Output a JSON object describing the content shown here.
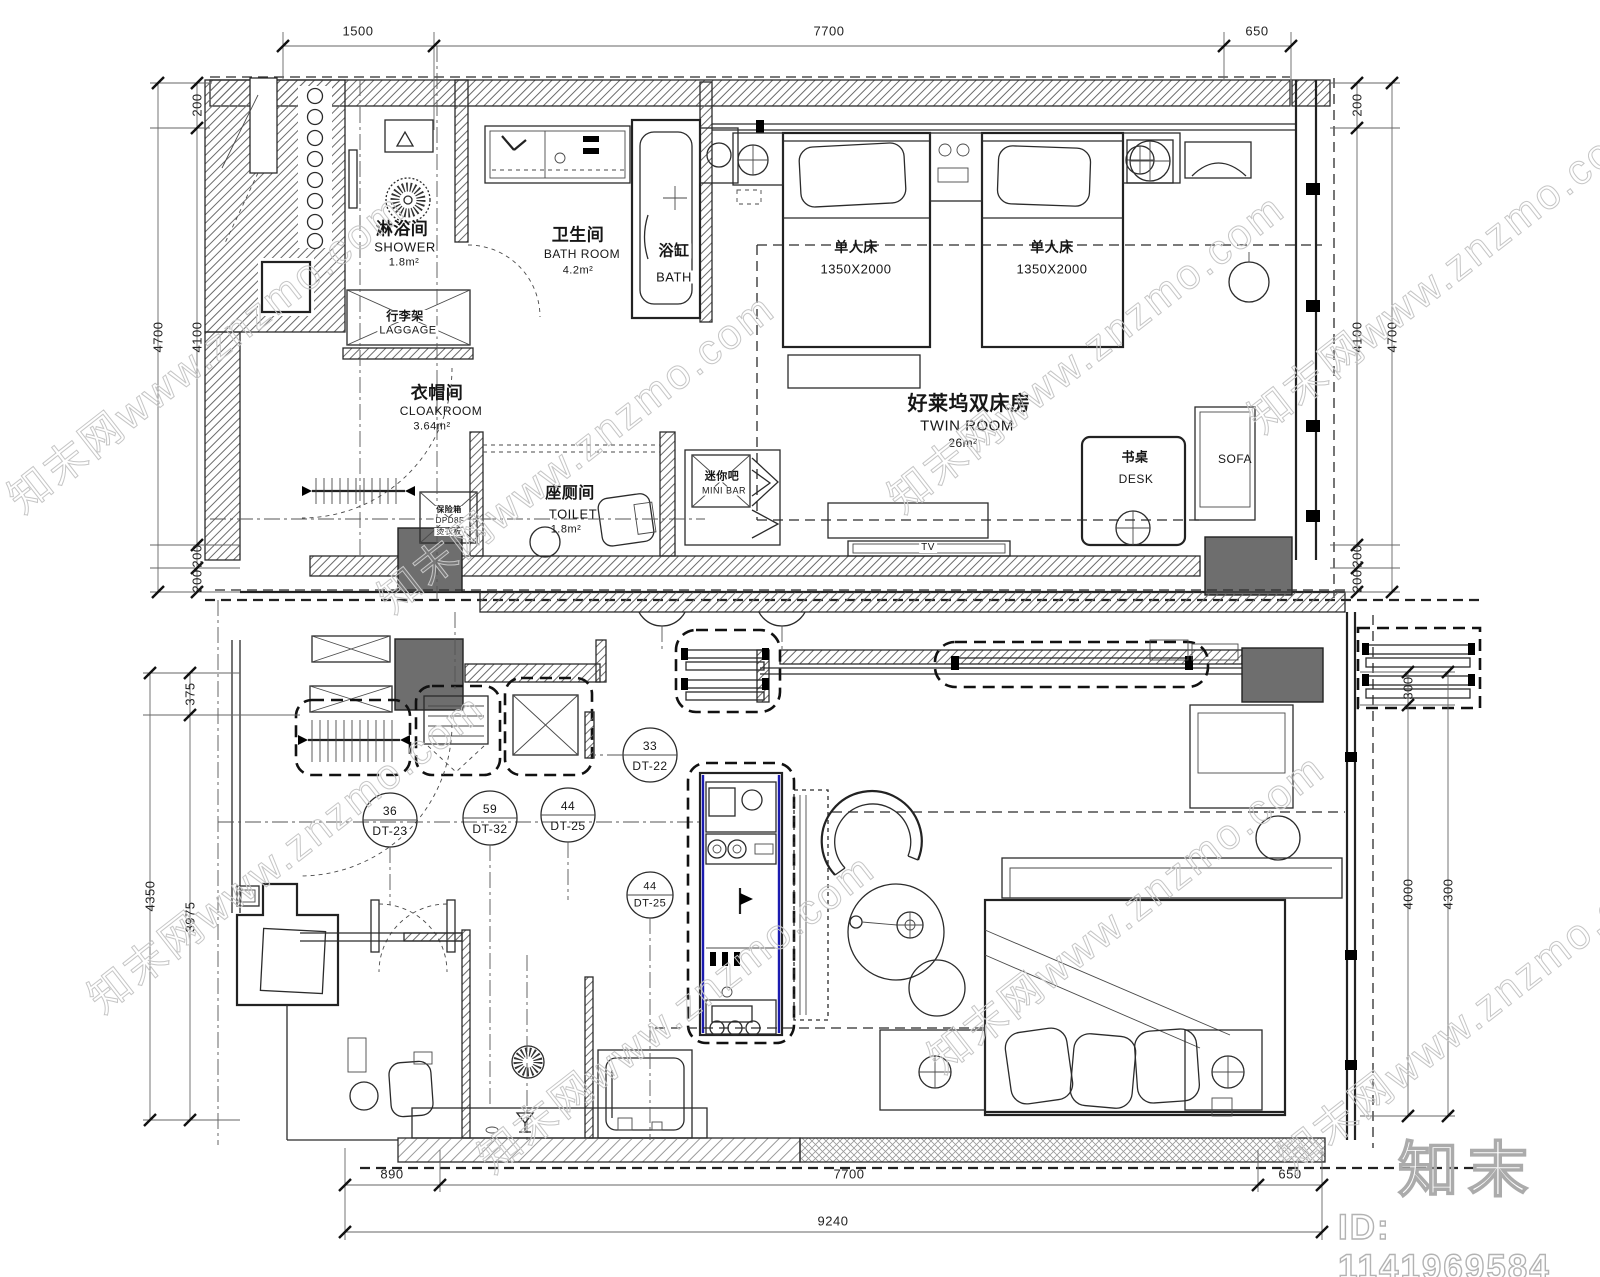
{
  "watermark": {
    "site_text": "知末网www.znzmo.com",
    "brand": "知末",
    "id_label": "ID: 1141969584"
  },
  "top_plan": {
    "dims": {
      "top": [
        "1500",
        "7700",
        "650"
      ],
      "left_inner": [
        "200",
        "4100",
        "200",
        "200"
      ],
      "left_total": "4700",
      "right_inner": [
        "200",
        "4100",
        "200",
        "200"
      ],
      "right_total": "4700"
    },
    "labels": {
      "shower": {
        "cn": "淋浴间",
        "en": "SHOWER",
        "area": "1.8m²"
      },
      "bathroom": {
        "cn": "卫生间",
        "en": "BATH ROOM",
        "area": "4.2m²"
      },
      "bathtub": {
        "cn": "浴缸",
        "en": "BATH"
      },
      "luggage": {
        "cn": "行李架",
        "en": "LAGGAGE"
      },
      "cloakroom": {
        "cn": "衣帽间",
        "en": "CLOAKROOM",
        "area": "3.64m²"
      },
      "toilet": {
        "cn": "座厕间",
        "en": "TOILET",
        "area": "1.8m²"
      },
      "minibar": {
        "cn": "迷你吧",
        "en": "MINI BAR"
      },
      "twin_room": {
        "cn": "好莱坞双床房",
        "en": "TWIN ROOM",
        "area": "26m²"
      },
      "bed_left": {
        "cn": "单人床",
        "size": "1350X2000"
      },
      "bed_right": {
        "cn": "单人床",
        "size": "1350X2000"
      },
      "desk": {
        "cn": "书桌",
        "en": "DESK"
      },
      "sofa": {
        "en": "SOFA"
      },
      "tv": {
        "en": "TV"
      },
      "safe": {
        "l1": "保险箱",
        "l2": "DPD8F",
        "l3": "烫衣板"
      }
    }
  },
  "bottom_plan": {
    "dims": {
      "left_inner": [
        "375",
        "3975"
      ],
      "left_total": "4350",
      "right_inner": [
        "300",
        "4000"
      ],
      "right_total": "4300",
      "bottom": [
        "890",
        "7700",
        "650"
      ],
      "bottom_total": "9240"
    },
    "callouts": [
      {
        "num": "33",
        "code": "DT-22"
      },
      {
        "num": "36",
        "code": "DT-23"
      },
      {
        "num": "59",
        "code": "DT-32"
      },
      {
        "num": "44",
        "code": "DT-25"
      },
      {
        "num": "44",
        "code": "DT-25"
      }
    ]
  },
  "colors": {
    "line": "#2b2b2b",
    "column_fill": "#6e6e6e",
    "panel_accent": "#1b1bb0",
    "watermark": "#c8c8c8"
  }
}
